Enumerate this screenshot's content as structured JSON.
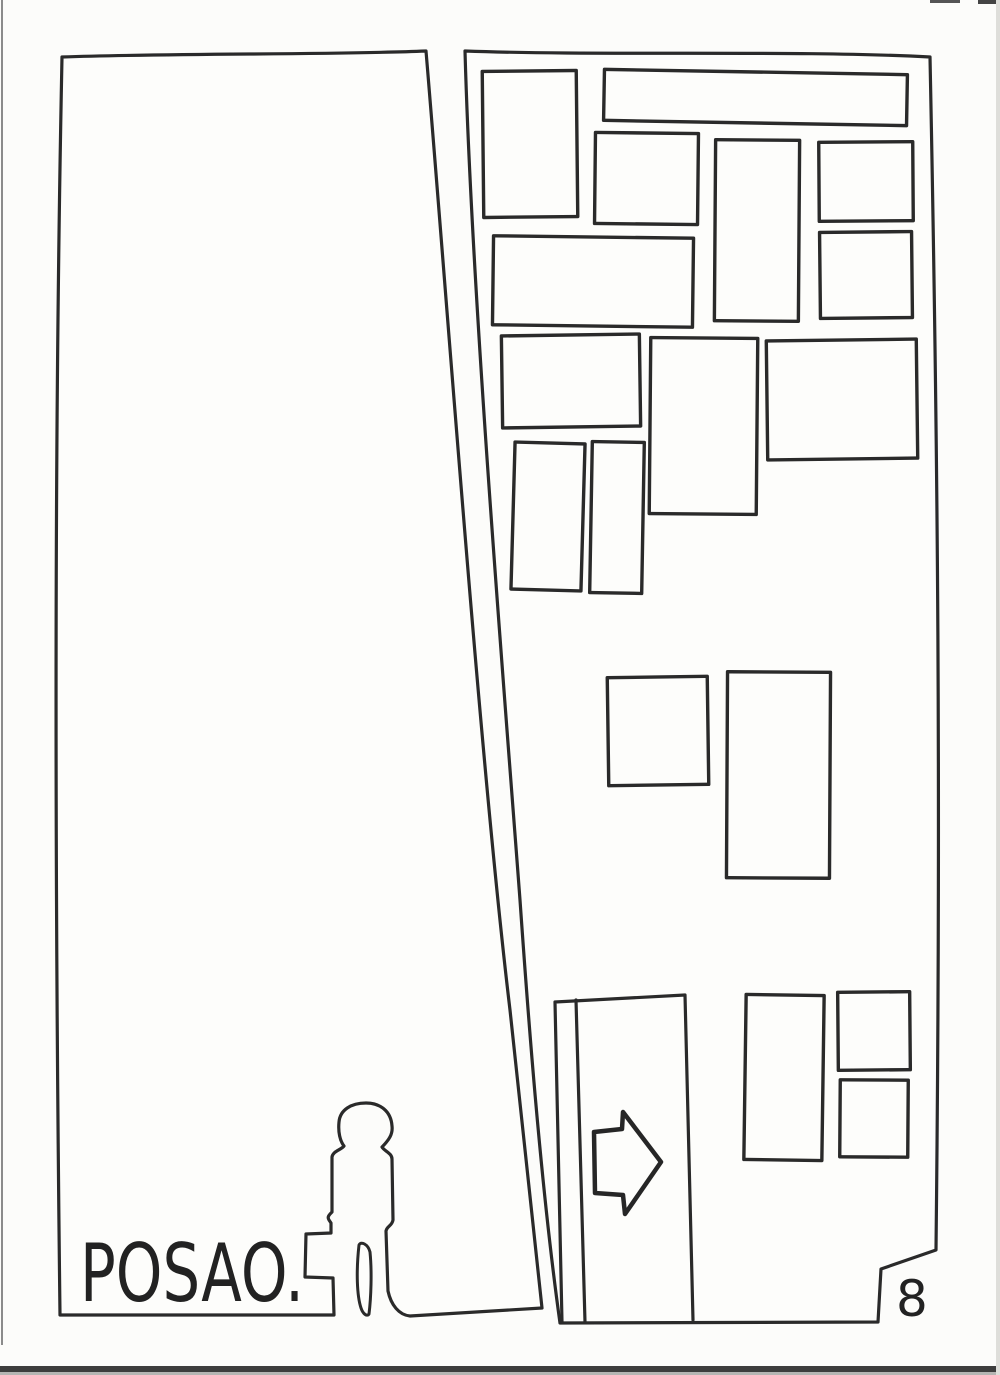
{
  "page": {
    "caption": "POSAO.",
    "page_number": "8",
    "colors": {
      "ink": "#2a2a2a",
      "paper": "#fcfcfa",
      "scan_band_dark": "#3d3d3d",
      "scan_edge_gray": "#8b8b8b"
    },
    "icons": {
      "arrow": "right-arrow-icon",
      "person": "standing-person-silhouette-icon",
      "briefcase": "briefcase-silhouette-icon"
    }
  },
  "drawing": {
    "windows": [
      {
        "x": 483,
        "y": 71,
        "w": 94,
        "h": 146,
        "r": -0.6
      },
      {
        "x": 604,
        "y": 72,
        "w": 303,
        "h": 51,
        "r": 1.0
      },
      {
        "x": 595,
        "y": 133,
        "w": 103,
        "h": 91,
        "r": 0.6
      },
      {
        "x": 715,
        "y": 140,
        "w": 84,
        "h": 181,
        "r": 0.4
      },
      {
        "x": 819,
        "y": 142,
        "w": 94,
        "h": 79,
        "r": -0.4
      },
      {
        "x": 493,
        "y": 237,
        "w": 200,
        "h": 89,
        "r": 0.7
      },
      {
        "x": 820,
        "y": 232,
        "w": 92,
        "h": 86,
        "r": -0.6
      },
      {
        "x": 502,
        "y": 335,
        "w": 138,
        "h": 92,
        "r": -0.8
      },
      {
        "x": 650,
        "y": 338,
        "w": 107,
        "h": 176,
        "r": 0.5
      },
      {
        "x": 767,
        "y": 340,
        "w": 150,
        "h": 119,
        "r": -0.7
      },
      {
        "x": 513,
        "y": 443,
        "w": 70,
        "h": 147,
        "r": 1.6
      },
      {
        "x": 591,
        "y": 442,
        "w": 52,
        "h": 151,
        "r": 1.0
      },
      {
        "x": 608,
        "y": 677,
        "w": 100,
        "h": 108,
        "r": -0.8
      },
      {
        "x": 727,
        "y": 672,
        "w": 103,
        "h": 206,
        "r": 0.3
      },
      {
        "x": 745,
        "y": 995,
        "w": 78,
        "h": 165,
        "r": 0.8
      },
      {
        "x": 838,
        "y": 992,
        "w": 72,
        "h": 78,
        "r": -0.5
      },
      {
        "x": 840,
        "y": 1080,
        "w": 68,
        "h": 77,
        "r": 0.4
      }
    ]
  }
}
